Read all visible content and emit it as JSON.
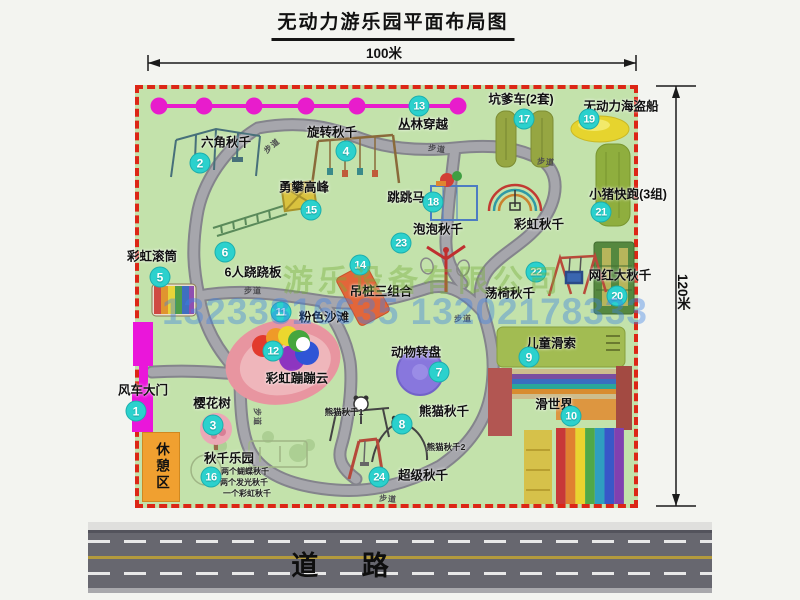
{
  "title": "无动力游乐园平面布局图",
  "dimensions": {
    "width_label": "100米",
    "height_label": "120米"
  },
  "road": {
    "label": "道 路"
  },
  "rest_area": {
    "label": "休憩区"
  },
  "path_label": "步道",
  "watermark": {
    "company": "游乐设备有限公司",
    "phone": "13233816635 13202178333"
  },
  "attractions": [
    {
      "num": "1",
      "label": "风车大门"
    },
    {
      "num": "2",
      "label": "六角秋千"
    },
    {
      "num": "3",
      "label": "樱花树"
    },
    {
      "num": "4",
      "label": "旋转秋千"
    },
    {
      "num": "5",
      "label": "彩虹滚筒"
    },
    {
      "num": "6",
      "label": "6人跷跷板"
    },
    {
      "num": "7",
      "label": "动物转盘"
    },
    {
      "num": "8",
      "label": "熊猫秋千"
    },
    {
      "num": "9",
      "label": "儿童滑索"
    },
    {
      "num": "10",
      "label": "滑世界"
    },
    {
      "num": "11",
      "label": "粉色沙滩"
    },
    {
      "num": "12",
      "label": "彩虹蹦蹦云"
    },
    {
      "num": "13",
      "label": "丛林穿越"
    },
    {
      "num": "14",
      "label": "吊桩三组合"
    },
    {
      "num": "15",
      "label": "勇攀高峰"
    },
    {
      "num": "16",
      "label": "秋千乐园"
    },
    {
      "num": "17",
      "label": "坑爹车(2套)"
    },
    {
      "num": "18",
      "label": "跳跳马"
    },
    {
      "num": "19",
      "label": "无动力海盗船"
    },
    {
      "num": "20",
      "label": "网红大秋千"
    },
    {
      "num": "21",
      "label": "小猪快跑(3组)"
    },
    {
      "num": "22",
      "label": "荡椅秋千"
    },
    {
      "num": "23",
      "label": "泡泡秋千"
    },
    {
      "num": "24",
      "label": "超级秋千"
    }
  ],
  "extra": {
    "rainbow_swing": "彩虹秋千",
    "panda_swing_1": "熊猫秋千1",
    "panda_swing_2": "熊猫秋千2",
    "swing_park_notes": [
      "两个蝴蝶秋千",
      "两个发光秋千",
      "一个彩虹秋千"
    ]
  },
  "colors": {
    "park_green": "#c3e2ab",
    "border_red": "#dc2616",
    "badge_cyan": "#2bd1cd",
    "gate_magenta": "#ea16da",
    "chain_magenta": "#e81ccc",
    "road_gray": "#67676f",
    "rest_orange": "#f0a030",
    "watermark_blue": "#3c82e6",
    "watermark_green": "#78af3c"
  }
}
